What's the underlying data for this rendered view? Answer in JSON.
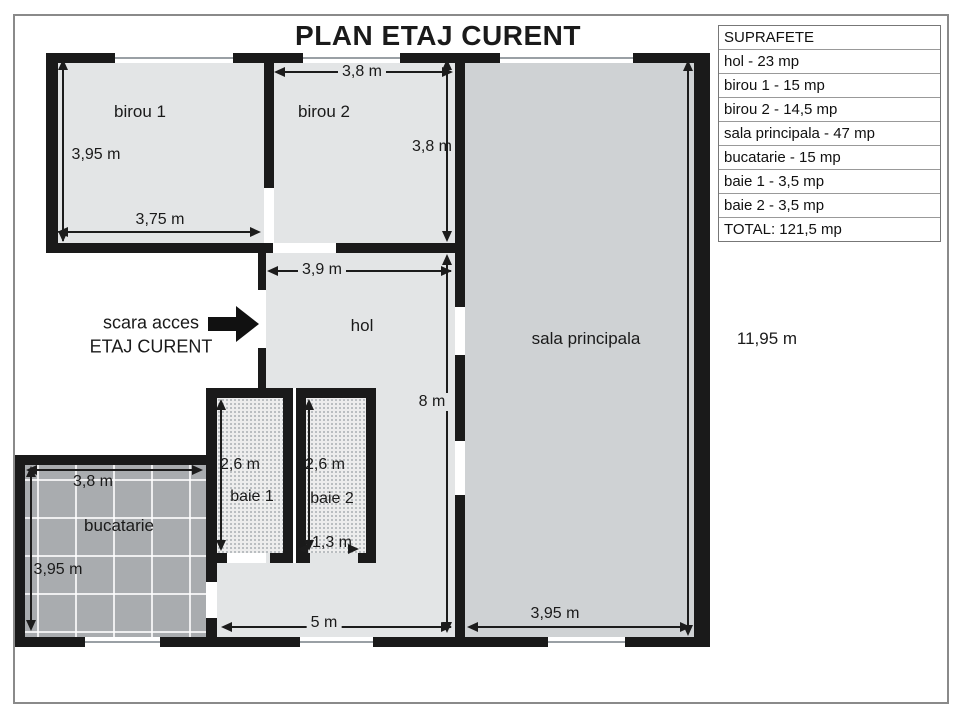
{
  "title": "PLAN ETAJ CURENT",
  "rooms": {
    "birou1": "birou 1",
    "birou2": "birou 2",
    "hol": "hol",
    "sala": "sala principala",
    "bucatarie": "bucatarie",
    "baie1": "baie 1",
    "baie2": "baie 2"
  },
  "stairs": {
    "line1": "scara acces",
    "line2": "ETAJ CURENT"
  },
  "dims": {
    "birou1_h": "3,95 m",
    "birou1_w": "3,75 m",
    "birou2_w": "3,8 m",
    "birou2_h": "3,8 m",
    "hol_w": "3,9 m",
    "hol_h": "8 m",
    "hol_bottom_w": "5 m",
    "sala_bottom_w": "3,95 m",
    "building_h": "11,95 m",
    "bucatarie_w": "3,8 m",
    "bucatarie_h": "3,95 m",
    "baie1_h": "2,6 m",
    "baie2_h": "2,6 m",
    "baie2_door_w": "1,3 m"
  },
  "table": {
    "rows": [
      "SUPRAFETE",
      "hol - 23 mp",
      "birou 1 - 15 mp",
      "birou 2 - 14,5 mp",
      "sala principala - 47 mp",
      "bucatarie - 15 mp",
      "baie 1 - 3,5 mp",
      "baie 2 - 3,5 mp",
      "TOTAL: 121,5 mp"
    ]
  },
  "colors": {
    "wall": "#1a1a1a",
    "room_fill": "#e3e5e6",
    "sala_fill": "#cfd2d4",
    "kitchen_fill": "#a9acaf",
    "bath_fill": "#ededed",
    "bath_dot": "#a9aeb2",
    "frame": "#8a8a8a"
  }
}
